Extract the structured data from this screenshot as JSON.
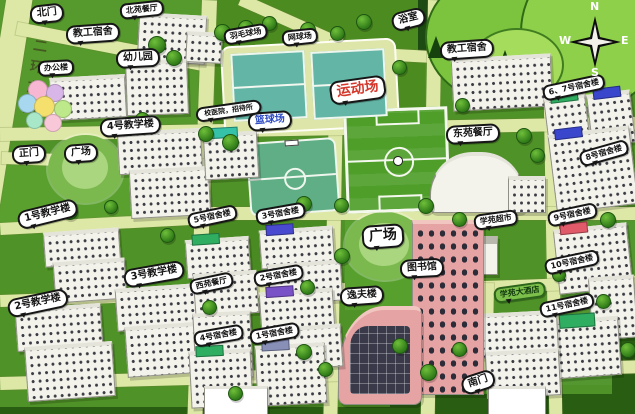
{
  "compass": {
    "n": "N",
    "e": "E",
    "s": "S",
    "w": "W"
  },
  "colors": {
    "grass": "#4f9227",
    "road": "#dde8a6",
    "forest_dark": "#1c4a12",
    "hill_green": "#7cc33e",
    "court_teal": "#63b5a6",
    "field_green": "#4f9e2a",
    "building_white": "#f3f3ec",
    "building_pink": "#e6a3a3",
    "label_bg": "#ffffff",
    "sports_label_red": "#d4382c",
    "basketball_label_blue": "#2b49c4",
    "hotel_label_green": "#7cbf4a"
  },
  "labels": {
    "north_gate": "北门",
    "staff_dorm_left": "教工宿舍",
    "north_canteen": "北苑餐厅",
    "kindergarten": "幼儿园",
    "office_building": "办公楼",
    "badminton_court": "羽毛球场",
    "tennis_court": "网球场",
    "bath_house": "浴室",
    "staff_dorm_right": "教工宿舍",
    "sports_field": "运动场",
    "basketball_court": "篮球场",
    "clinic_guesthouse": "校医院，招待所",
    "teach_4": "4号教学楼",
    "plaza_left": "广场",
    "east_canteen": "东苑餐厅",
    "dorm_6_7": "6、7号宿舍楼",
    "teach_1": "1号教学楼",
    "dorm_5": "5号宿舍楼",
    "dorm_3": "3号宿舍楼",
    "dorm_8": "8号宿舍楼",
    "dorm_9": "9号宿舍楼",
    "supermarket": "学苑超市",
    "plaza_center": "广场",
    "library": "图书馆",
    "teach_2": "2号教学楼",
    "teach_3": "3号教学楼",
    "west_canteen": "西苑餐厅",
    "dorm_2": "2号宿舍楼",
    "yifu_building": "逸夫楼",
    "dorm_10": "10号宿舍楼",
    "hotel": "学苑大酒店",
    "dorm_11": "11号宿舍楼",
    "dorm_4": "4号宿舍楼",
    "dorm_1": "1号宿舍楼",
    "south_gate": "南门",
    "main_gate": "正门",
    "ring_road": "二环东路"
  }
}
